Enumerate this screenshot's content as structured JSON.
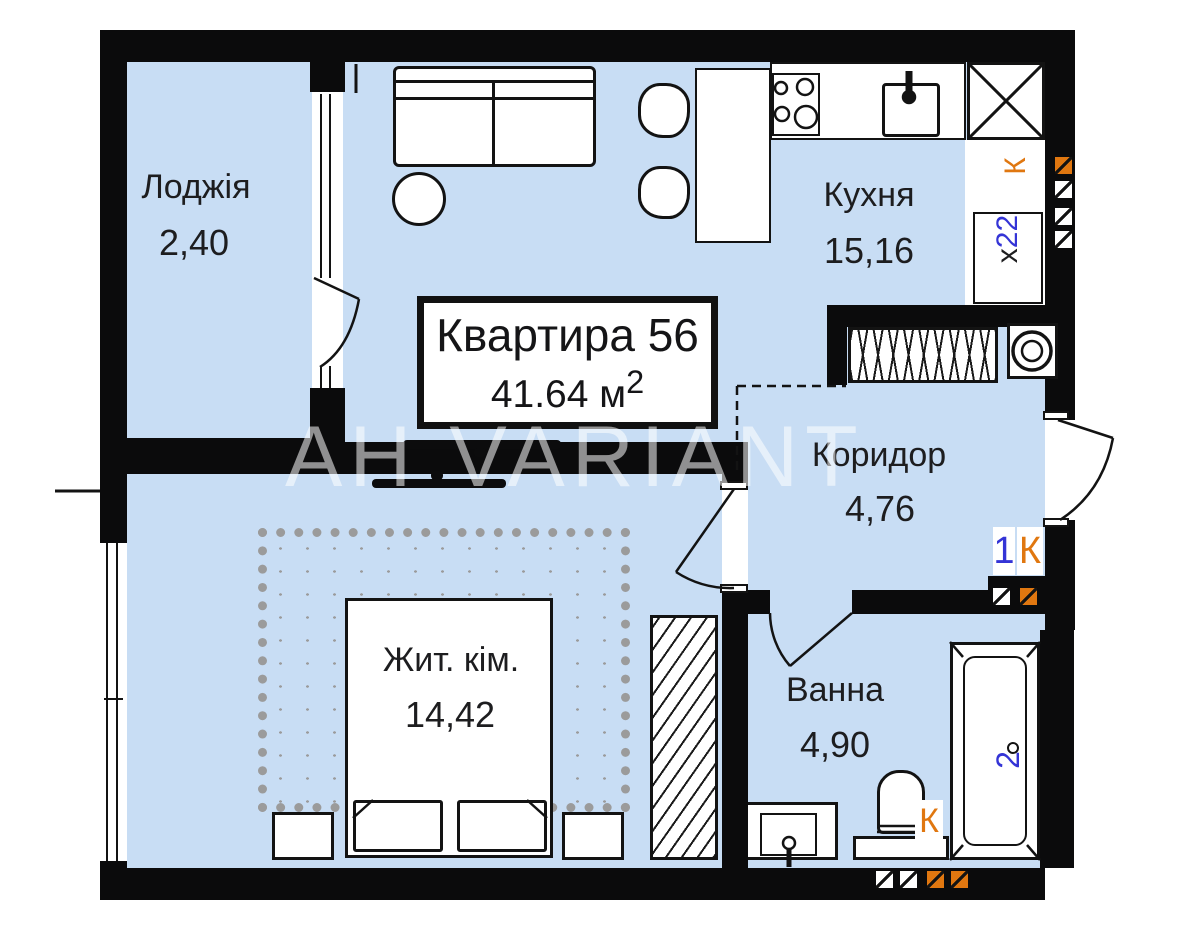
{
  "title": {
    "name": "Квартира 56",
    "area_value": "41.64 м",
    "area_sup": "2"
  },
  "rooms": {
    "loggia": {
      "label": "Лоджія",
      "area": "2,40"
    },
    "kitchen": {
      "label": "Кухня",
      "area": "15,16"
    },
    "corridor": {
      "label": "Коридор",
      "area": "4,76"
    },
    "living": {
      "label": "Жит. кім.",
      "area": "14,42"
    },
    "bath": {
      "label": "Ванна",
      "area": "4,90"
    }
  },
  "marks": {
    "riser_k": "К",
    "duct_x": "х",
    "duct_22": "22",
    "entry_num": "1",
    "entry_k": "К",
    "bath_k": "К",
    "tub_num": "2"
  },
  "watermark": "АН VARIANT",
  "colors": {
    "floor": "#c8ddf4",
    "wall": "#0b0b0c",
    "accent_orange": "#e07710",
    "accent_blue": "#3434d6",
    "carpet": "#9b9b9b"
  }
}
